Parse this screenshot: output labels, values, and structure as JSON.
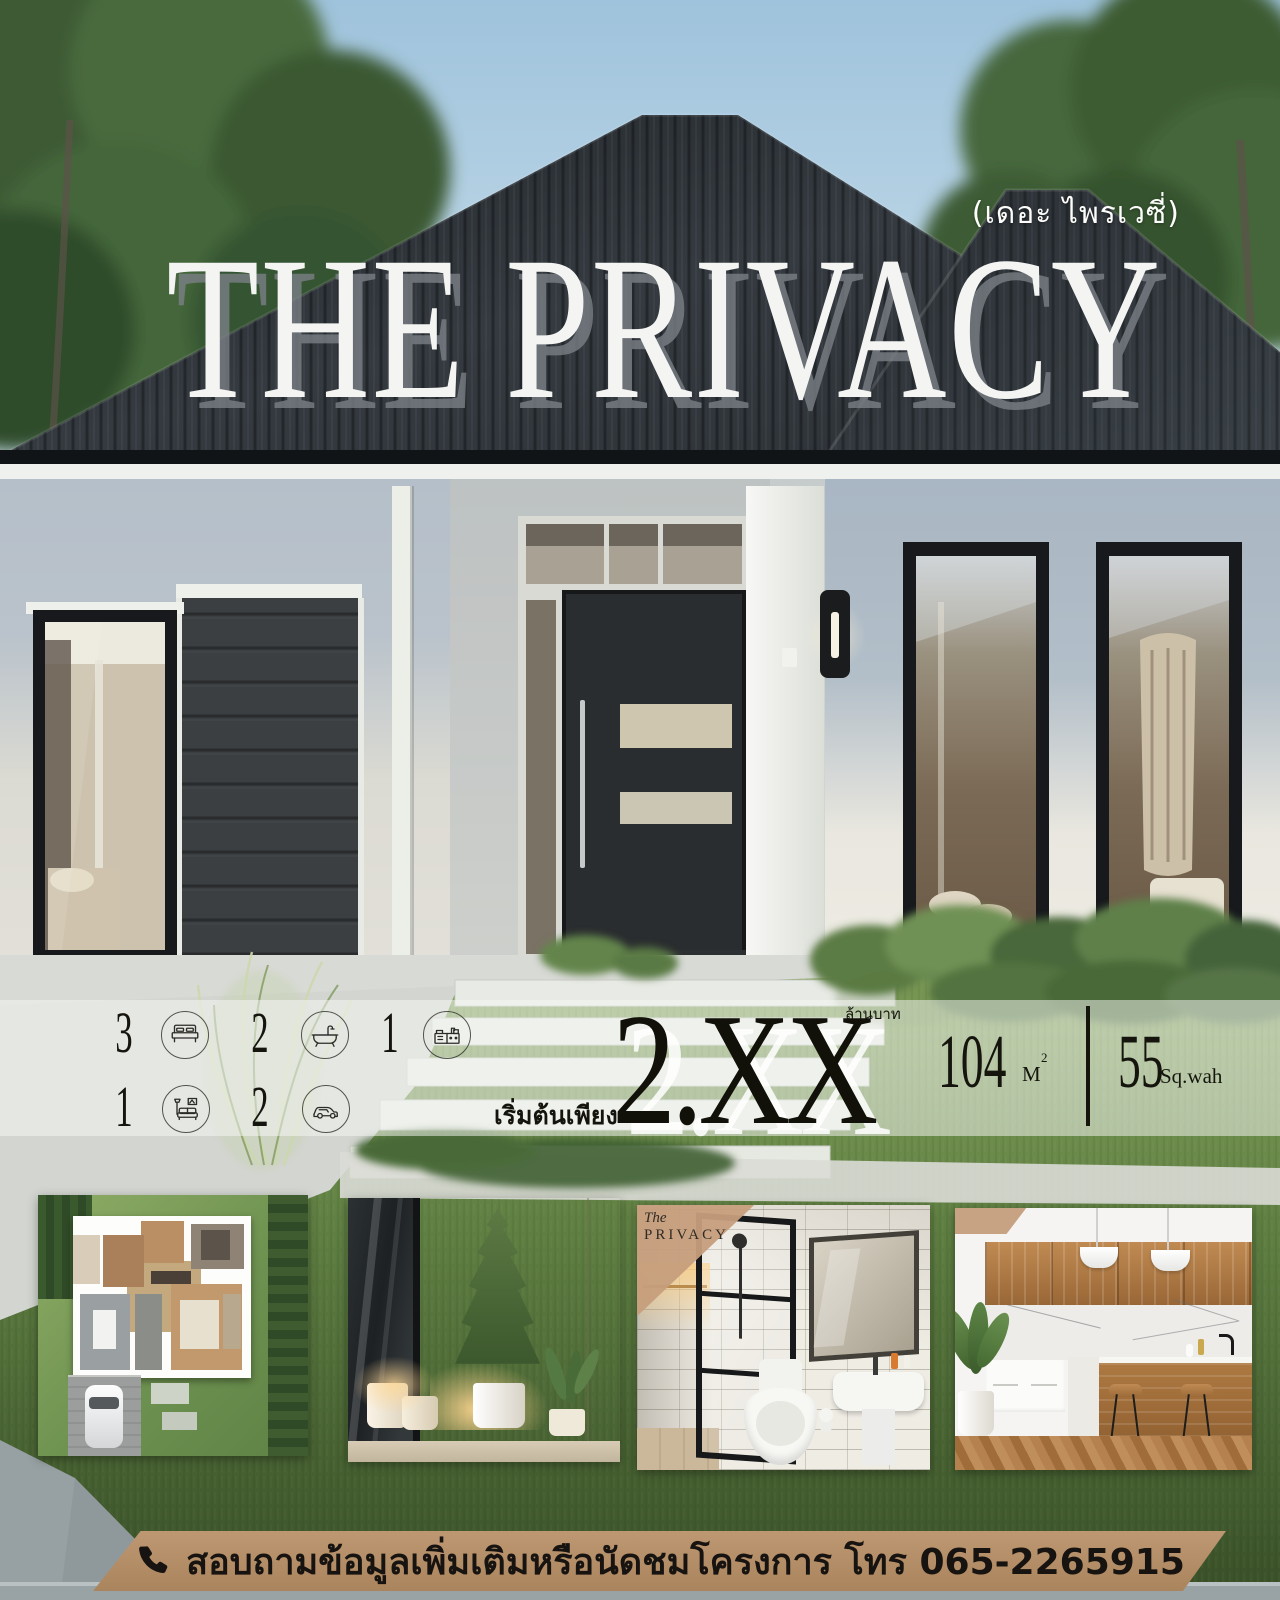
{
  "poster": {
    "brand": {
      "subtitle_thai": "(เดอะ ไพรเวซี่)",
      "title": "THE PRIVACY"
    },
    "specs": {
      "rows": [
        {
          "items": [
            {
              "count": "3",
              "icon": "bed"
            },
            {
              "count": "2",
              "icon": "bathtub"
            },
            {
              "count": "1",
              "icon": "kitchen"
            }
          ]
        },
        {
          "items": [
            {
              "count": "1",
              "icon": "living-room"
            },
            {
              "count": "2",
              "icon": "car"
            }
          ]
        }
      ]
    },
    "price": {
      "prefix": "เริ่มต้นเพียง",
      "amount": "2.XX",
      "unit": "ล้านบาท"
    },
    "area": {
      "usable_value": "104",
      "usable_unit": "M",
      "usable_exponent": "2",
      "land_value": "55",
      "land_unit": "Sq.wah"
    },
    "gallery": [
      {
        "name": "floor-plan"
      },
      {
        "name": "entrance-garden"
      },
      {
        "name": "bathroom",
        "badge": {
          "script": "The",
          "title": "PRIVACY"
        }
      },
      {
        "name": "kitchen"
      }
    ],
    "contact": {
      "icon": "phone",
      "message": "สอบถามข้อมูลเพิ่มเติมหรือนัดชมโครงการ โทร 065-2265915"
    }
  },
  "colors": {
    "contact_bar": "#b5906a",
    "badge_tan": "#c49d7c",
    "roof": "#2f343a",
    "price_text": "#111109",
    "title_text": "#f4f5f3"
  }
}
